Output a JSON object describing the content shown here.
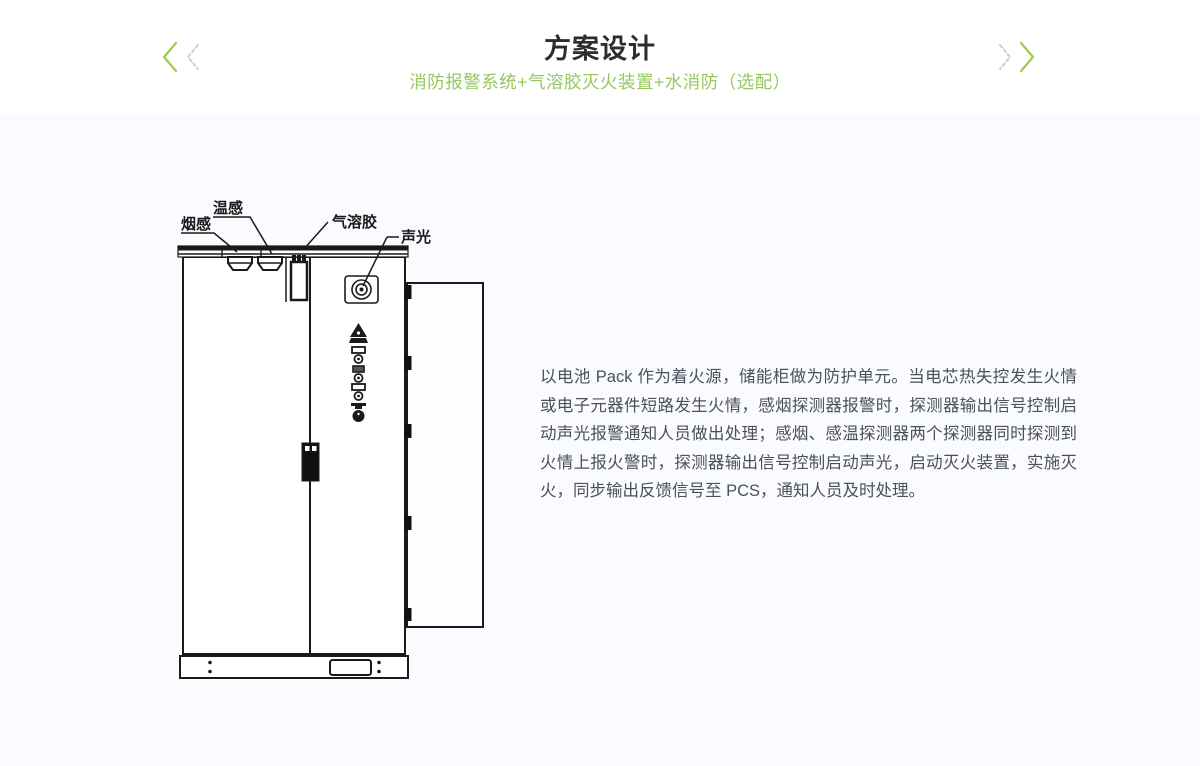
{
  "header": {
    "title": "方案设计",
    "subtitle": "消防报警系统+气溶胶灭火装置+水消防（选配）",
    "accent_green": "#8fc445",
    "arrow_gray": "#cccccc"
  },
  "diagram": {
    "labels": {
      "smoke": "烟感",
      "temp": "温感",
      "aerosol": "气溶胶",
      "sound_light": "声光"
    }
  },
  "body_text": {
    "paragraph": "以电池 Pack 作为着火源，储能柜做为防护单元。当电芯热失控发生火情或电子元器件短路发生火情，感烟探测器报警时，探测器输出信号控制启动声光报警通知人员做出处理；感烟、感温探测器两个探测器同时探测到火情上报火警时，探测器输出信号控制启动声光，启动灭火装置，实施灭火，同步输出反馈信号至 PCS，通知人员及时处理。"
  }
}
